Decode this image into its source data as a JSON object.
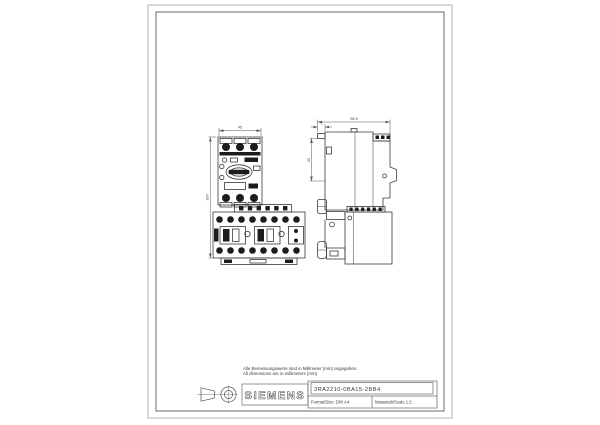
{
  "drawing": {
    "notes": {
      "line1": "Alle Bemessungswerte sind in Millimeter (mm) angegeben.",
      "line2": "All dimensions are in millimeters (mm)"
    },
    "dims": {
      "front_width": "45",
      "front_height": "160",
      "side_depth": "96.5",
      "side_tab": "7",
      "side_upper": "35"
    },
    "titleblock": {
      "brand": "SIEMENS",
      "part_number": "3RA2210-0BA15-2BB4",
      "format_label": "Format/Size: DIN A4",
      "scale_label": "Massstab/Scale 1:2"
    },
    "colors": {
      "line": "#3a3a3a",
      "fill_dark": "#1c1c1c",
      "frame": "#9a9a9a"
    }
  }
}
